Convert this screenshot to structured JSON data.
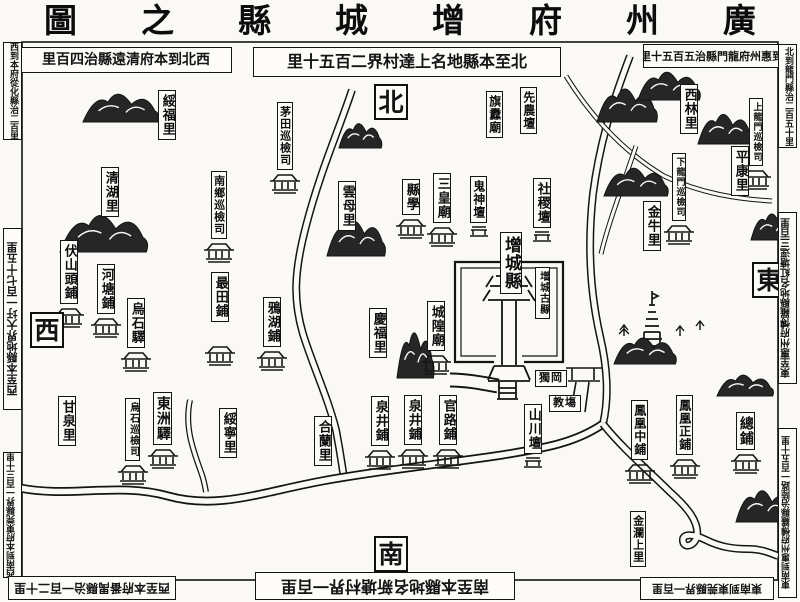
{
  "map_title": {
    "display": "圖之縣城增府州廣",
    "reading": "廣州府增城縣之圖"
  },
  "directions": [
    {
      "id": "north",
      "label": "北",
      "x": 374,
      "y": 84
    },
    {
      "id": "west",
      "label": "西",
      "x": 30,
      "y": 312
    },
    {
      "id": "east",
      "label": "東",
      "x": 752,
      "y": 262
    },
    {
      "id": "south",
      "label": "南",
      "x": 374,
      "y": 536
    }
  ],
  "border_notes": [
    {
      "id": "top-left",
      "text": "里百四治縣遠清府本到北西",
      "reading": "西北到本府清遠縣治四百里",
      "x": 20,
      "y": 47,
      "w": 212,
      "h": 26,
      "orient": "h",
      "flip": false,
      "fs": 14
    },
    {
      "id": "top-center",
      "text": "里十五百二界村達上名地縣本至北",
      "reading": "北至本縣地名上達村界二百五十里",
      "x": 253,
      "y": 47,
      "w": 308,
      "h": 30,
      "orient": "h",
      "flip": false,
      "fs": 16
    },
    {
      "id": "top-right",
      "text": "里十五百五治縣門龍府州惠到北",
      "reading": "北到惠州府龍門縣治五百五十里",
      "x": 643,
      "y": 44,
      "w": 148,
      "h": 24,
      "orient": "h",
      "flip": false,
      "fs": 11
    },
    {
      "id": "left-top",
      "text": "西到本府從化縣治二百里",
      "x": 3,
      "y": 42,
      "w": 19,
      "h": 98,
      "orient": "v",
      "flip": false,
      "fs": 9
    },
    {
      "id": "left-middle",
      "text": "西至本縣地界大圩一百七十五里",
      "x": 3,
      "y": 228,
      "w": 19,
      "h": 182,
      "orient": "v",
      "flip": true,
      "fs": 11
    },
    {
      "id": "left-bottom",
      "text": "西南到本府東莞縣界一百三十里",
      "x": 3,
      "y": 452,
      "w": 19,
      "h": 126,
      "orient": "v",
      "flip": true,
      "fs": 9
    },
    {
      "id": "right-top",
      "text": "北到龍門縣治二百五十里",
      "x": 778,
      "y": 44,
      "w": 19,
      "h": 104,
      "orient": "v",
      "flip": false,
      "fs": 9
    },
    {
      "id": "right-middle",
      "text": "東至惠州府愽羅縣地名紅塘逕三百里",
      "x": 778,
      "y": 212,
      "w": 19,
      "h": 172,
      "orient": "v",
      "flip": true,
      "fs": 10
    },
    {
      "id": "right-bottom",
      "text": "東南到惠州府愽羅縣治陸路一百五十里",
      "x": 778,
      "y": 428,
      "w": 19,
      "h": 170,
      "orient": "v",
      "flip": true,
      "fs": 9
    },
    {
      "id": "bottom-left",
      "text": "西至本府番禺縣治一百二十里",
      "x": 8,
      "y": 576,
      "w": 168,
      "h": 24,
      "orient": "h",
      "flip": true,
      "fs": 12
    },
    {
      "id": "bottom-center",
      "text": "南至本縣地名新塘村界一百里",
      "x": 255,
      "y": 572,
      "w": 260,
      "h": 28,
      "orient": "h",
      "flip": true,
      "fs": 16
    },
    {
      "id": "bottom-right",
      "text": "東南到東莞縣界一百里",
      "x": 640,
      "y": 577,
      "w": 134,
      "h": 23,
      "orient": "h",
      "flip": true,
      "fs": 11
    }
  ],
  "places": [
    {
      "id": "suifu-li",
      "label": "綏福里",
      "x": 158,
      "y": 90
    },
    {
      "id": "qinghu-li",
      "label": "清湖里",
      "x": 101,
      "y": 167
    },
    {
      "id": "fushantou-pu",
      "label": "伏山頭鋪",
      "x": 60,
      "y": 240,
      "icon": "station"
    },
    {
      "id": "hetang-pu",
      "label": "河塘鋪",
      "x": 97,
      "y": 264,
      "icon": "station"
    },
    {
      "id": "wushi-yi",
      "label": "烏石驛",
      "x": 127,
      "y": 298,
      "icon": "station"
    },
    {
      "id": "zuitian-pu",
      "label": "最田鋪",
      "x": 211,
      "y": 272,
      "icon": "station",
      "icon_dy": 22
    },
    {
      "id": "yahu-pu",
      "label": "鴉湖鋪",
      "x": 263,
      "y": 297,
      "icon": "station"
    },
    {
      "id": "nanxiang-xunjiansi",
      "label": "南鄉巡檢司",
      "x": 211,
      "y": 171,
      "fs": 11,
      "icon": "station"
    },
    {
      "id": "maotian-xunjiansi",
      "label": "茅田巡檢司",
      "x": 277,
      "y": 102,
      "fs": 11,
      "icon": "station"
    },
    {
      "id": "ganquan-li",
      "label": "甘泉里",
      "x": 58,
      "y": 396
    },
    {
      "id": "wushi-xunjiansi",
      "label": "烏石巡檢司",
      "x": 125,
      "y": 398,
      "fs": 10,
      "icon": "station"
    },
    {
      "id": "dongzhou-yi",
      "label": "東洲驛",
      "x": 153,
      "y": 392,
      "fs": 14,
      "icon": "station"
    },
    {
      "id": "suining-li",
      "label": "綏寧里",
      "x": 219,
      "y": 408
    },
    {
      "id": "helan-li",
      "label": "合蘭里",
      "x": 314,
      "y": 416
    },
    {
      "id": "quanjing-pu-west",
      "label": "泉井鋪",
      "x": 371,
      "y": 396,
      "icon": "station"
    },
    {
      "id": "quanjing-pu-east",
      "label": "泉井鋪",
      "x": 404,
      "y": 395,
      "icon": "station"
    },
    {
      "id": "guanlu-pu",
      "label": "官路鋪",
      "x": 439,
      "y": 395,
      "icon": "station"
    },
    {
      "id": "shanchuan-tan",
      "label": "山川壇",
      "x": 524,
      "y": 404,
      "icon": "altar"
    },
    {
      "id": "yunmu-li",
      "label": "雲母里",
      "x": 338,
      "y": 181
    },
    {
      "id": "xian-xue",
      "label": "縣學",
      "x": 402,
      "y": 179,
      "icon": "station"
    },
    {
      "id": "sanhuang-miao",
      "label": "三皇廟",
      "x": 433,
      "y": 173,
      "icon": "station"
    },
    {
      "id": "guishen-tan",
      "label": "鬼神壇",
      "x": 470,
      "y": 176,
      "fs": 12,
      "icon": "altar"
    },
    {
      "id": "sheji-tan",
      "label": "社稷壇",
      "x": 533,
      "y": 178,
      "icon": "altar"
    },
    {
      "id": "zengcheng-xian",
      "label": "增城縣",
      "x": 500,
      "y": 232,
      "fs": 17
    },
    {
      "id": "zengcheng-guxian",
      "label": "增城古縣",
      "x": 535,
      "y": 267,
      "fs": 10
    },
    {
      "id": "chenghuang-miao",
      "label": "城隍廟",
      "x": 427,
      "y": 301,
      "icon": "station"
    },
    {
      "id": "qingfu-li",
      "label": "慶福里",
      "x": 369,
      "y": 308
    },
    {
      "id": "qidao-miao",
      "label": "旗纛廟",
      "x": 486,
      "y": 91,
      "fs": 12
    },
    {
      "id": "xiannong-tan",
      "label": "先農壇",
      "x": 520,
      "y": 87,
      "fs": 12
    },
    {
      "id": "xilin-li",
      "label": "西林里",
      "x": 680,
      "y": 84
    },
    {
      "id": "shanglongmen-xunjiansi",
      "label": "上龍門巡檢司",
      "x": 749,
      "y": 98,
      "fs": 9,
      "icon": "station"
    },
    {
      "id": "xialongmen-xunjiansi",
      "label": "下龍門巡檢司",
      "x": 672,
      "y": 153,
      "fs": 9,
      "icon": "station"
    },
    {
      "id": "pingkang-li",
      "label": "平康里",
      "x": 731,
      "y": 146
    },
    {
      "id": "jinniu-li",
      "label": "金牛里",
      "x": 643,
      "y": 201
    },
    {
      "id": "fenghuang-zhong-pu",
      "label": "鳳凰中鋪",
      "x": 631,
      "y": 400,
      "fs": 12,
      "icon": "station"
    },
    {
      "id": "fenghuang-zheng-pu",
      "label": "鳳凰正鋪",
      "x": 676,
      "y": 395,
      "fs": 12,
      "icon": "station"
    },
    {
      "id": "zong-pu",
      "label": "總鋪",
      "x": 736,
      "y": 412,
      "fs": 14,
      "icon": "station"
    },
    {
      "id": "jinlan-shang-li",
      "label": "金瀾上里",
      "x": 630,
      "y": 511,
      "fs": 11
    },
    {
      "id": "du-gang",
      "label": "獨岡",
      "x": 535,
      "y": 370,
      "fs": 11,
      "h": true
    },
    {
      "id": "jiao-chang",
      "label": "教塲",
      "x": 549,
      "y": 395,
      "fs": 11,
      "h": true
    }
  ],
  "colors": {
    "ink": "#141414",
    "paper": "#faf9f5",
    "cartouche_bg": "#fdfcf8"
  }
}
